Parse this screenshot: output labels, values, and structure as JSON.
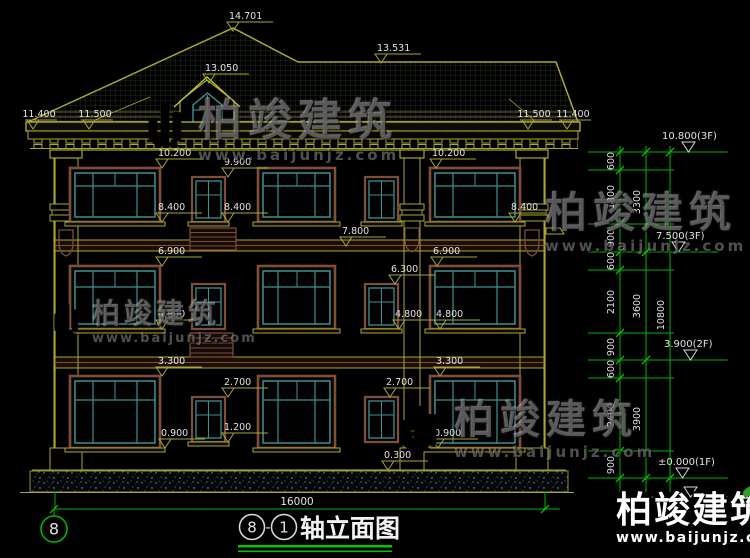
{
  "drawing": {
    "title": {
      "axis_a": "8",
      "separator": "-",
      "axis_b": "1",
      "label": "轴立面图"
    },
    "axis_bubble_left": "8",
    "elevations": {
      "v14701": "14.701",
      "v13531": "13.531",
      "v13050": "13.050",
      "v11500": "11.500",
      "v11400": "11.400",
      "v10200": "10.200",
      "v9900": "9.900",
      "v8400": "8.400",
      "v7800": "7.800",
      "v6900": "6.900",
      "v6300": "6.300",
      "v4800": "4.800",
      "v3300": "3.300",
      "v2700": "2.700",
      "v1200": "1.200",
      "v0900": "0.900",
      "v0300": "0.300"
    },
    "floor_levels": {
      "roof": "10.800(3F)",
      "f3": "7.500(3F)",
      "f2": "3.900(2F)",
      "f1": "±0.000(1F)"
    },
    "dims": {
      "d600": "600",
      "d900": "900",
      "d1800": "1800",
      "d2100": "2100",
      "d2400": "2400",
      "d3300": "3300",
      "d3600": "3600",
      "d3900": "3900",
      "d10800": "10800",
      "total": "16000"
    }
  },
  "watermark": {
    "brand": "柏竣建筑",
    "url": "www.baijunjz.com"
  },
  "colors": {
    "background": "#000000",
    "cad_yellow": "#aaa82f",
    "cad_yellow_bright": "#c8c634",
    "dim_green": "#00b400",
    "text_white": "#e2e2e2",
    "window_teal": "#3f9090",
    "frame_brown": "#7e4e3a",
    "logo_blue": "#2b6fd4",
    "logo_orange": "#f08a1e",
    "leaf_green": "#2f9e25"
  }
}
